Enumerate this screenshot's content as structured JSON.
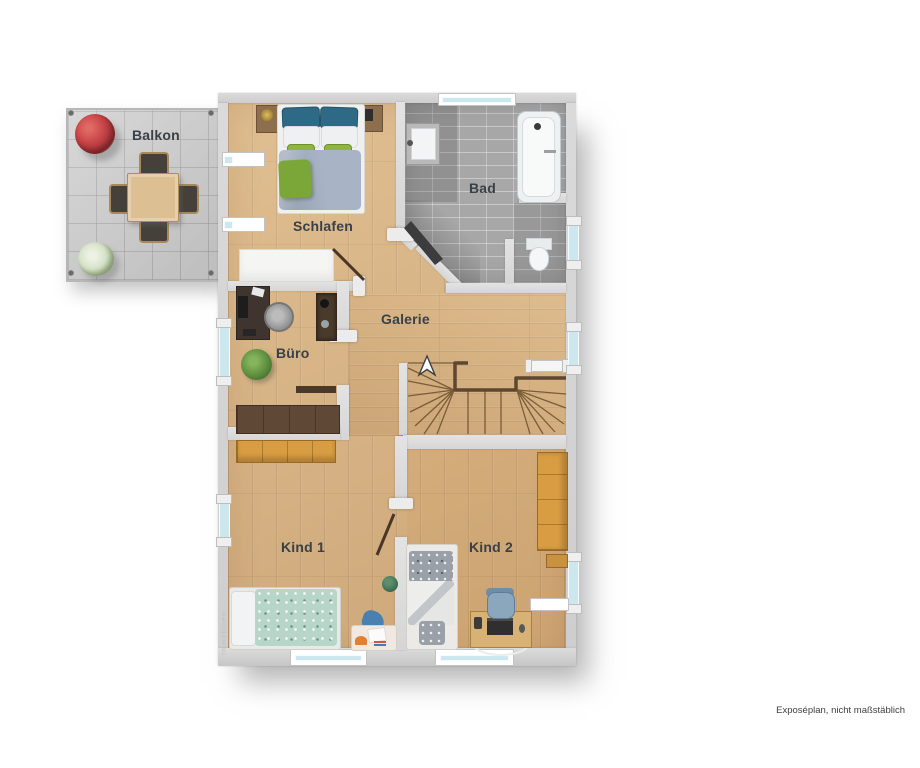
{
  "plan": {
    "footer_note": "Exposéplan, nicht maßstäblich",
    "watermark": "Immobilien",
    "rooms": [
      {
        "id": "balkon",
        "label": "Balkon"
      },
      {
        "id": "schlafen",
        "label": "Schlafen"
      },
      {
        "id": "bad",
        "label": "Bad"
      },
      {
        "id": "galerie",
        "label": "Galerie"
      },
      {
        "id": "buero",
        "label": "Büro"
      },
      {
        "id": "kind1",
        "label": "Kind 1"
      },
      {
        "id": "kind2",
        "label": "Kind 2"
      }
    ],
    "stairs": {
      "direction": "up"
    },
    "colors": {
      "wall": "#d2d2d2",
      "wood_floor": "#d9b587",
      "bad_tile": "#a7a7a7",
      "balcony_tile": "#cbcbcb",
      "window_glass": "#cde7ee",
      "door_leaf_dark": "#3c3c3c",
      "wardrobe_wood": "#d89c42",
      "pillow_blue": "#2e6a86",
      "cushion_green": "#8fb440",
      "label_text": "#3a4047"
    }
  }
}
